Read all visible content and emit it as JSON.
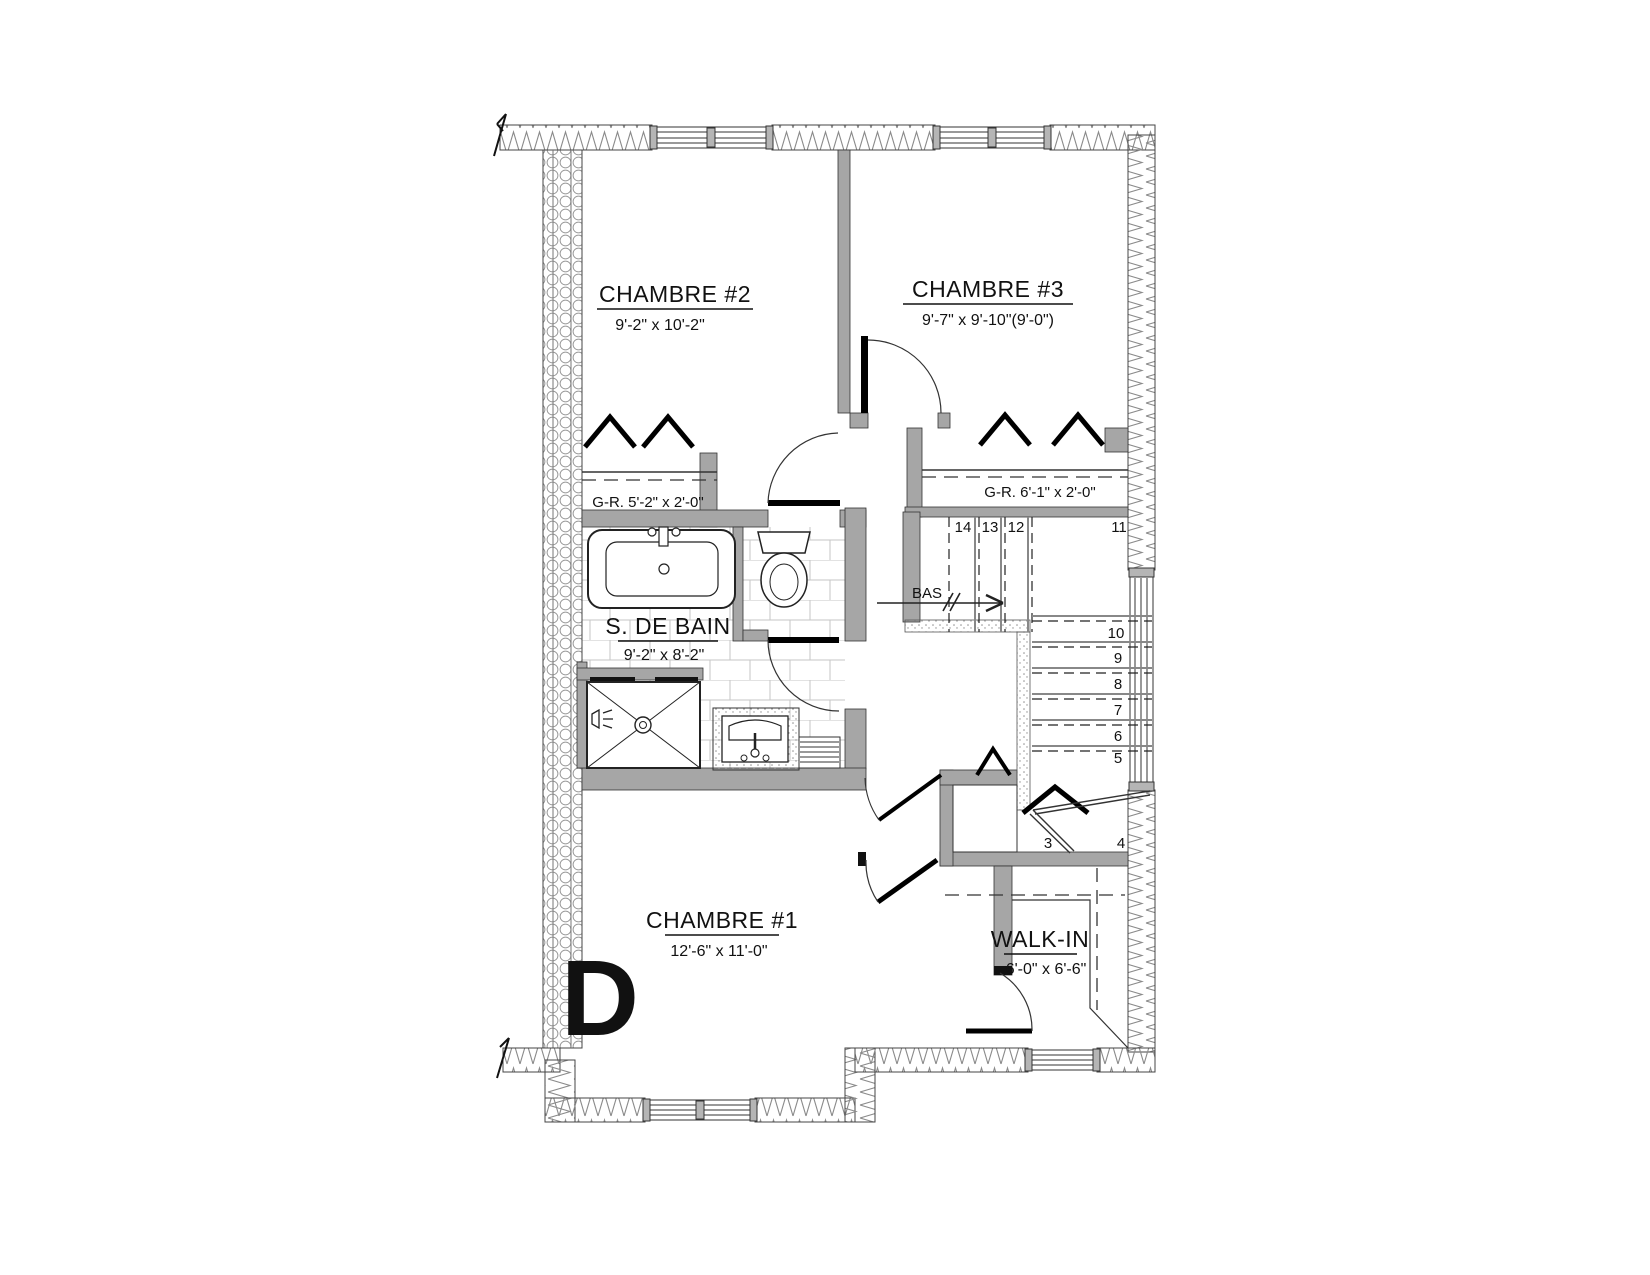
{
  "rooms": {
    "ch2": {
      "name": "CHAMBRE #2",
      "dims": "9'-2\" x 10'-2\""
    },
    "ch3": {
      "name": "CHAMBRE #3",
      "dims": "9'-7\" x 9'-10\"(9'-0\")"
    },
    "bath": {
      "name": "S. DE BAIN",
      "dims": "9'-2\" x 8'-2\""
    },
    "ch1": {
      "name": "CHAMBRE #1",
      "dims": "12'-6\" x 11'-0\""
    },
    "walkin": {
      "name": "WALK-IN",
      "dims": "6'-0\" x 6'-6\""
    }
  },
  "closets": {
    "gr2": "G-R. 5'-2\" x 2'-0\"",
    "gr3": "G-R. 6'-1\" x 2'-0\""
  },
  "stairs": {
    "direction_label": "BAS",
    "treads": [
      "14",
      "13",
      "12",
      "11",
      "10",
      "9",
      "8",
      "7",
      "6",
      "5",
      "4",
      "3"
    ]
  },
  "unit_label": "D",
  "colors": {
    "wall": "#a6a6a6",
    "line": "#1a1a1a",
    "tile": "#c6c6c6"
  }
}
